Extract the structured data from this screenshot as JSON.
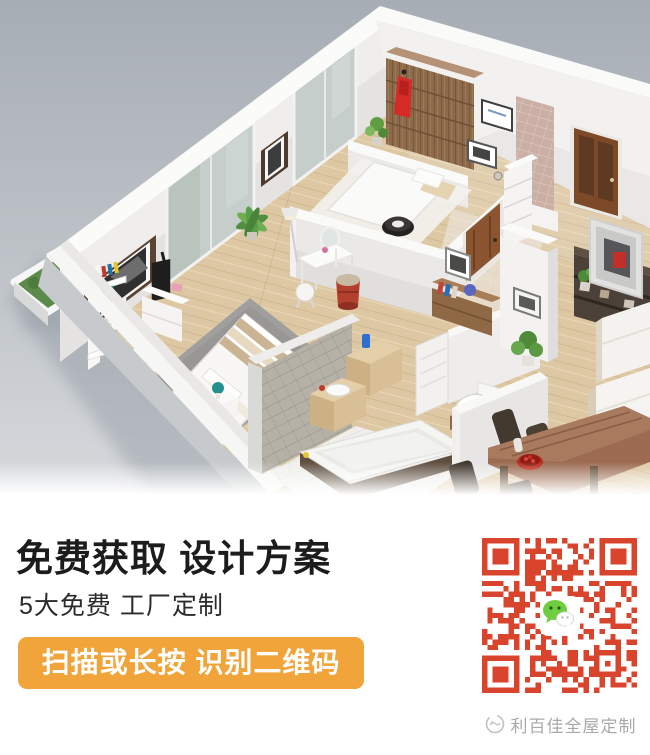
{
  "promo": {
    "heading": "免费获取 设计方案",
    "subheading": "5大免费 工厂定制",
    "cta_label": "扫描或长按 识别二维码",
    "brand": "利百佳全屋定制",
    "colors": {
      "cta_bg": "#F0A43A",
      "cta_text": "#FFFFFF",
      "qr_module": "#D9442C",
      "wechat_green": "#6FCE3F",
      "heading_text": "#1C1C1C",
      "subheading_text": "#2B2B2B",
      "brand_text": "#A9A9A9",
      "render_sky_top": "#A7ADB5",
      "render_sky_bottom": "#D3D6DA",
      "wood_floor": "#DECAA6"
    },
    "icons": {
      "wechat_icon": "wechat-chat-bubbles",
      "brand_logo_icon": "round-sketch-logo",
      "qr_icon": "qr-code"
    }
  }
}
